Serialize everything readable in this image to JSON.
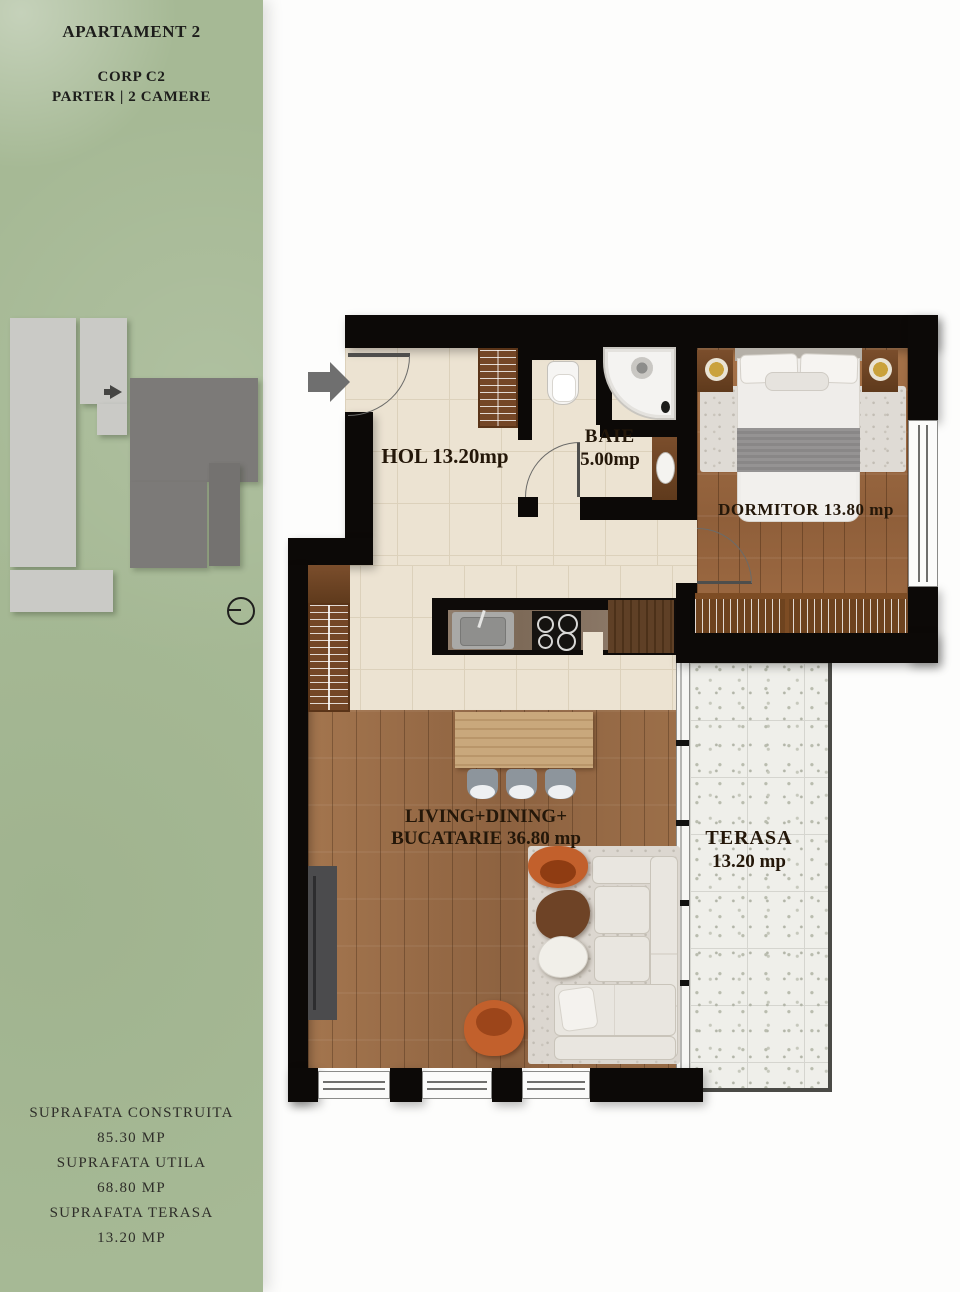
{
  "sidebar": {
    "title": "APARTAMENT 2",
    "building": "CORP C2",
    "floor_info": "PARTER | 2 CAMERE",
    "stats": [
      {
        "label": "SUPRAFATA CONSTRUITA",
        "value": "85.30 MP"
      },
      {
        "label": "SUPRAFATA UTILA",
        "value": "68.80 MP"
      },
      {
        "label": "SUPRAFATA TERASA",
        "value": "13.20 MP"
      }
    ]
  },
  "site_plan": {
    "highlight_arrow_icon": "right-arrow",
    "north_icon": "circle-with-line"
  },
  "floor_plan": {
    "entrance_icon": "right-arrow",
    "rooms": {
      "hol": {
        "label": "HOL 13.20mp"
      },
      "baie": {
        "name": "BAIE",
        "area": "5.00mp"
      },
      "dormitor": {
        "label": "DORMITOR 13.80 mp"
      },
      "living": {
        "line1": "LIVING+DINING+",
        "line2": "BUCATARIE 36.80 mp"
      },
      "terasa": {
        "name": "TERASA",
        "area": "13.20 mp"
      }
    }
  },
  "colors": {
    "sidebar_green": "#a6b995",
    "wall_black": "#0c0907",
    "tile_floor": "#ece3d2",
    "wood_floor": "#9c6e49",
    "terrace_tile": "#efefea",
    "accent_orange": "#c2602c"
  }
}
